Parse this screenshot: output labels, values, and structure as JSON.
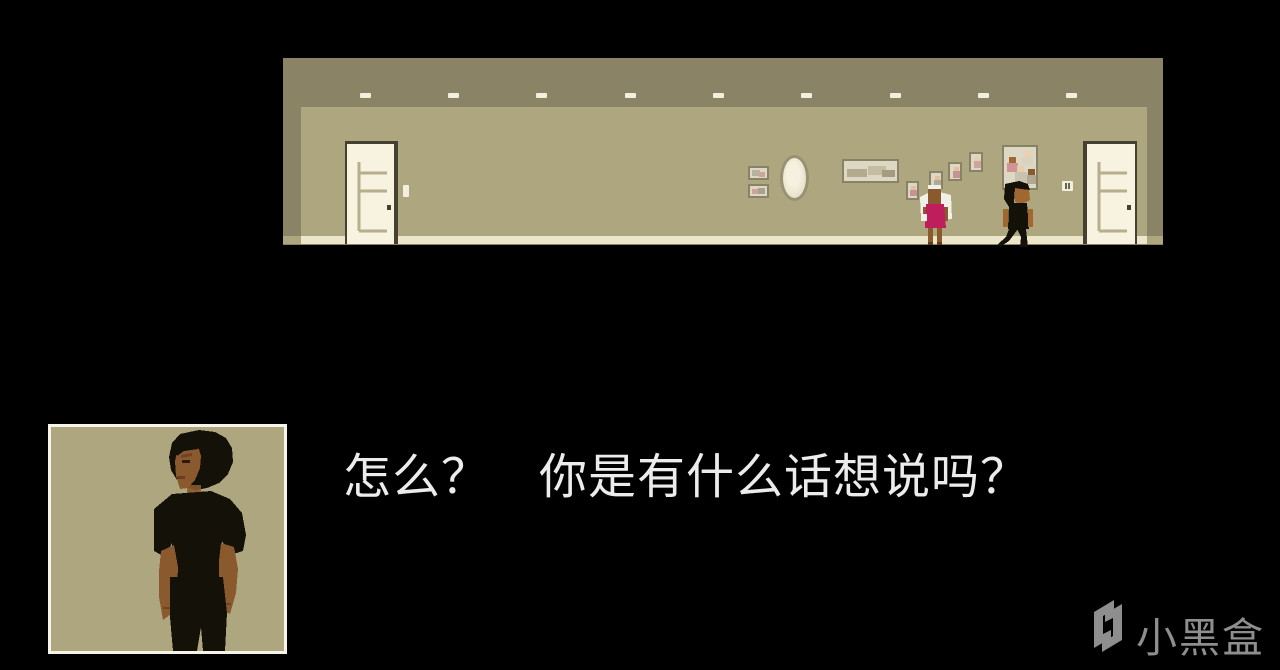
{
  "dialogue": {
    "text": "怎么？　你是有什么话想说吗？"
  },
  "watermark": {
    "brand": "小黑盒",
    "logo": "heybox-logo"
  },
  "palette": {
    "background": "#000000",
    "scene_border": "#8b8365",
    "wall": "#aea67f",
    "floor": "#ece6cb",
    "door": "#f7f3e0",
    "door_frame": "#45402f",
    "door_groove": "#b7ae8d",
    "picture_frame": "#8a8266",
    "picture_interior": "#ddd8c4",
    "ceiling_light": "#f3efdd",
    "girl_dress": "#bf1e5c",
    "girl_hair": "#f0efe8",
    "skin_dark": "#8a5a2e",
    "skin_medium": "#a06830",
    "character_black": "#131108",
    "portrait_border": "#f6f4e9",
    "dialogue_text": "#ececec",
    "watermark": "#8e8e8e"
  }
}
